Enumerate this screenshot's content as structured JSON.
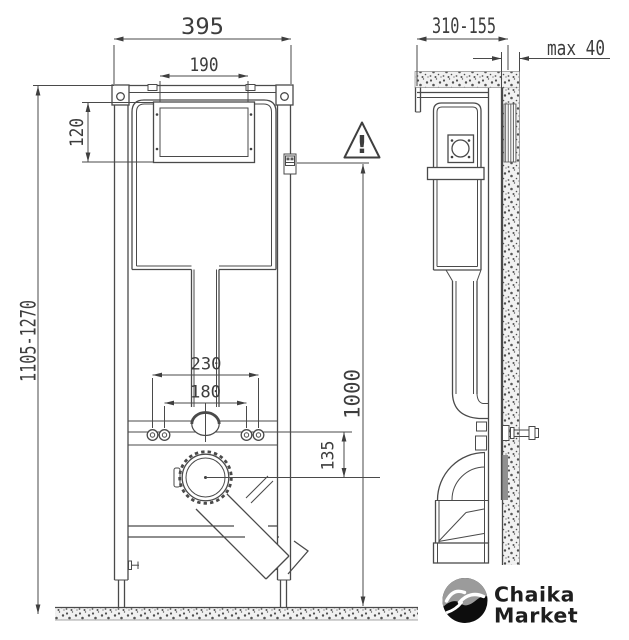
{
  "drawing_title": "wc-installation-frame-technical-drawing",
  "front_view": {
    "dims": {
      "total_width": "395",
      "flush_plate_width": "190",
      "flush_plate_height": "120",
      "install_height_range": "1105-1270",
      "fixing_spacing_outer": "230",
      "fixing_spacing_inner": "180",
      "outlet_offset": "135",
      "panel_axis_height": "1000"
    }
  },
  "side_view": {
    "dims": {
      "depth_adjust_range": "310-155",
      "max_finish_thickness": "max 40"
    }
  },
  "warning": {
    "mark": "!"
  },
  "logo": {
    "name_line1": "Chaika",
    "name_line2": "Market"
  },
  "colors": {
    "line": "#4a4a4a",
    "dimension_text": "#3d3d3d",
    "speckle_band_bg": "#f1f1f1",
    "speckle_dot": "#4f4f4f",
    "wall_rail_gray": "#909090",
    "logo_sky_gray": "#9b9b9b",
    "logo_circle": "#0d0d0d",
    "logo_bird": "#ffffff"
  }
}
